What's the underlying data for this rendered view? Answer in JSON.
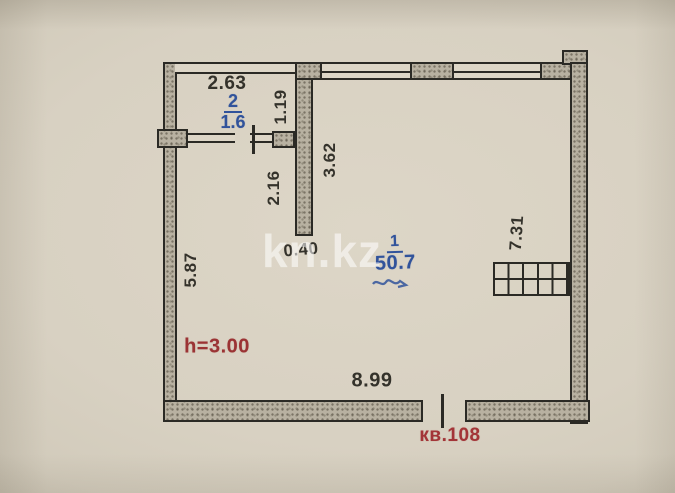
{
  "watermark": "kn.kz",
  "plan": {
    "rooms": [
      {
        "number": "2",
        "area": "1.6"
      },
      {
        "number": "1",
        "area": "50.7"
      }
    ],
    "dimensions": {
      "room2_width": "2.63",
      "room2_height": "1.19",
      "inner_wall_length": "3.62",
      "below_room2_height": "2.16",
      "wall_stub_width": "0.40",
      "left_side_height": "5.87",
      "right_side_height": "7.31",
      "bottom_width": "8.99"
    },
    "annotations": {
      "ceiling_height": "h=3.00",
      "apartment_number": "кв.108"
    }
  },
  "colors": {
    "paper": "#d8d1c2",
    "wall_fill": "#b8b1a1",
    "line": "#2b2a25",
    "blue_label": "#31539b",
    "red_label": "#9b3334",
    "watermark": "rgba(255,255,255,0.55)"
  }
}
